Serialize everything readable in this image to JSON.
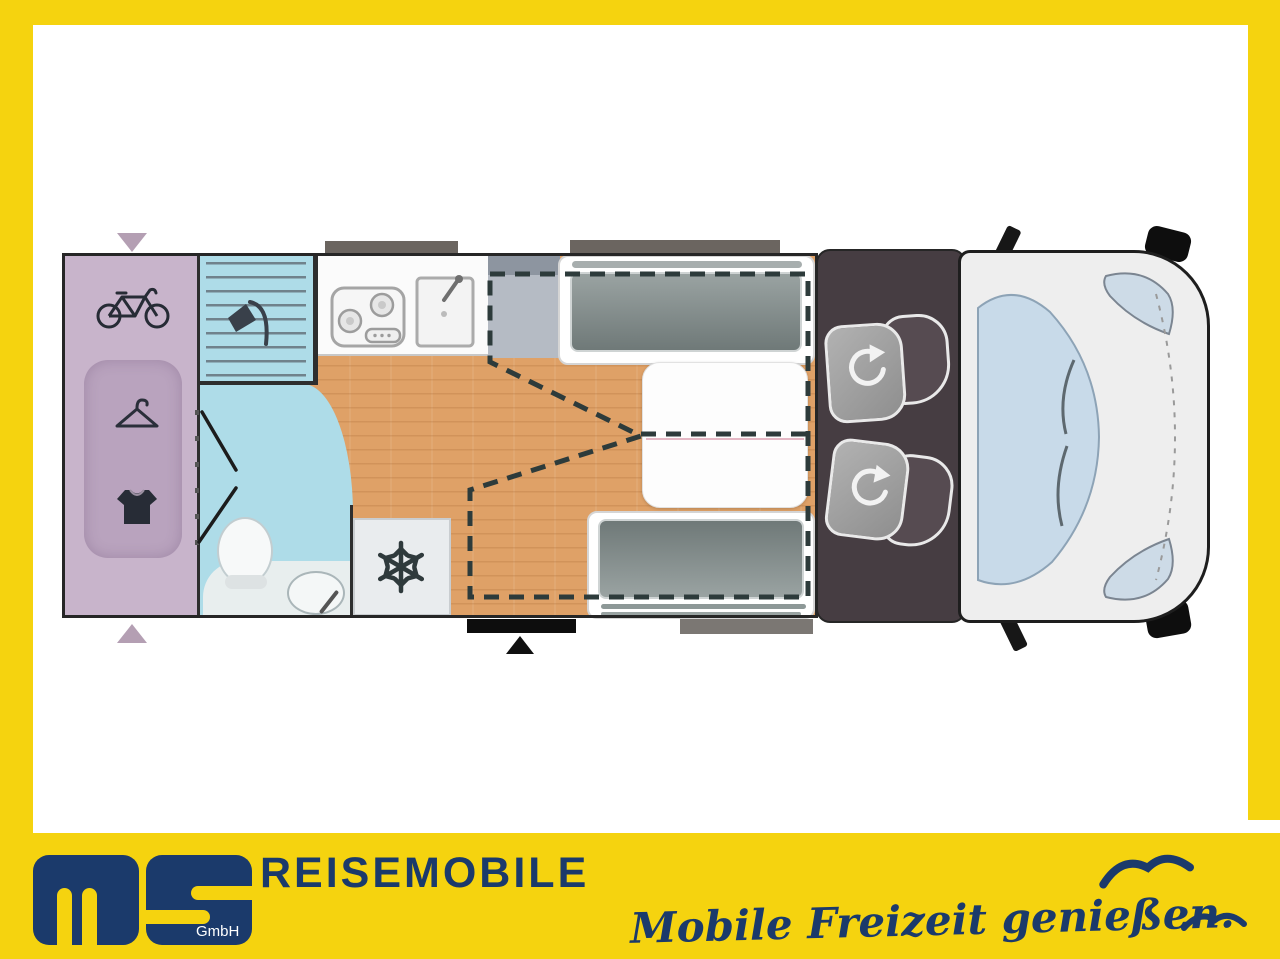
{
  "branding": {
    "logo_text": "ms",
    "logo_suffix": "GmbH",
    "wordmark": "REISEMOBILE",
    "tagline": "Mobile Freizeit genießen."
  },
  "colors": {
    "frame_yellow": "#F5D30F",
    "brand_navy": "#1B3A6B",
    "garage_purple": "#C8B4CB",
    "wardrobe_purple": "#B9A3BE",
    "bath_blue": "#AEDCE8",
    "floor_wood": "#DFA167",
    "cab_dark": "#463D42",
    "windshield_blue": "#C8DAE9",
    "cushion_gray": "#8A9493",
    "dashed_outline": "#2D3B3B"
  },
  "floorplan": {
    "zones": [
      {
        "name": "rear-garage",
        "icons": [
          "bicycle-icon",
          "hanger-icon",
          "tshirt-icon"
        ]
      },
      {
        "name": "shower-cubicle",
        "icons": [
          "shower-head-icon"
        ]
      },
      {
        "name": "washroom",
        "icons": [
          "toilet",
          "washbasin"
        ]
      },
      {
        "name": "kitchen",
        "icons": [
          "stove-icon",
          "sink-icon"
        ]
      },
      {
        "name": "fridge",
        "icons": [
          "snowflake-icon"
        ]
      },
      {
        "name": "dinette",
        "icons": [
          "table",
          "bench-seat",
          "bench-seat",
          "drop-down-bed-outline"
        ]
      },
      {
        "name": "cab",
        "icons": [
          "swivel-seat-rotate-icon",
          "swivel-seat-rotate-icon"
        ]
      }
    ],
    "markers": [
      "window-marker",
      "window-marker",
      "window-marker",
      "entry-door-marker",
      "door-arrow",
      "garage-arrow",
      "garage-arrow"
    ]
  }
}
